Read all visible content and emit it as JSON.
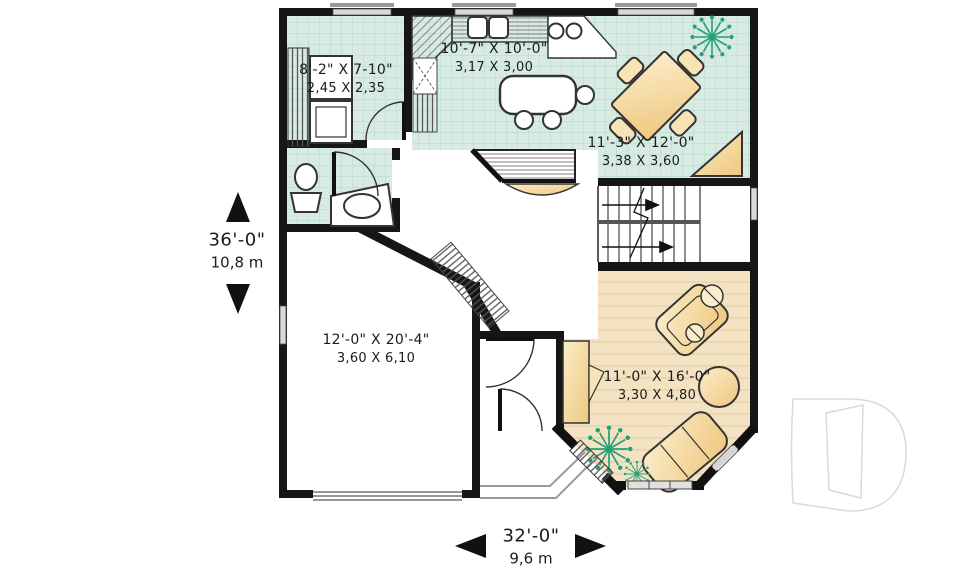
{
  "floor_plan": {
    "rooms": {
      "laundry": {
        "imperial": "8'-2\" X 7-10\"",
        "metric": "2,45 X 2,35"
      },
      "kitchen": {
        "imperial": "10'-7\" X 10'-0\"",
        "metric": "3,17 X 3,00"
      },
      "dining": {
        "imperial": "11'-3\" X 12'-0\"",
        "metric": "3,38 X 3,60"
      },
      "garage": {
        "imperial": "12'-0\" X 20'-4\"",
        "metric": "3,60 X 6,10"
      },
      "living": {
        "imperial": "11'-0\" X 16'-0\"",
        "metric": "3,30 X 4,80"
      }
    },
    "overall_depth": {
      "imperial": "36'-0\"",
      "metric": "10,8 m"
    },
    "overall_width": {
      "imperial": "32'-0\"",
      "metric": "9,6 m"
    },
    "logo_letter": "D",
    "colors": {
      "wall": "#161616",
      "tile_floor": "#d7ebe2",
      "tile_grid": "#b4d8ca",
      "wood_floor": "#f3e3c3",
      "furniture": "#f2d49a",
      "plant": "#27a07a",
      "window": "#d8d8d8",
      "logo_outline": "#d9d9d9"
    }
  }
}
